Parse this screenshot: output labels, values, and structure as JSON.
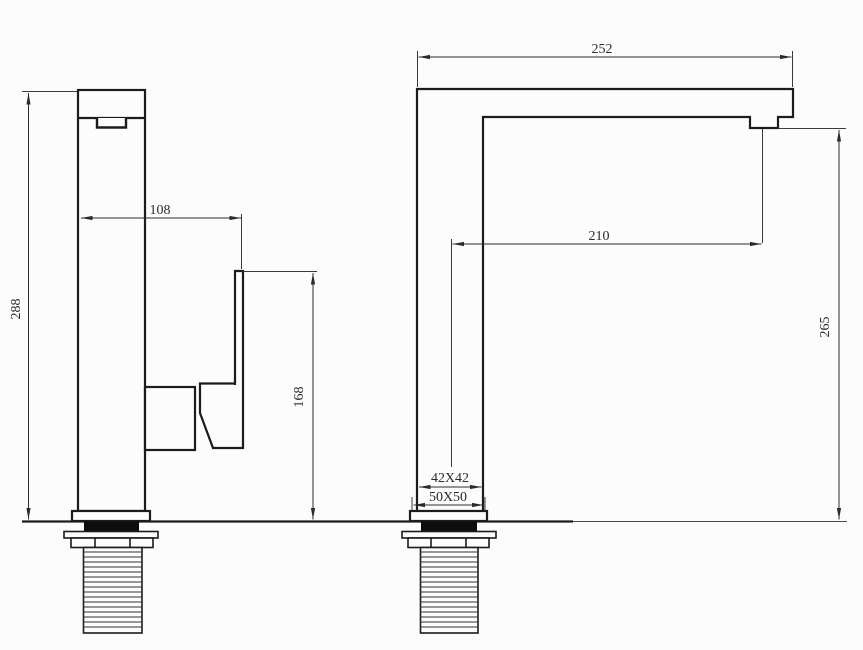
{
  "drawing": {
    "background_color": "#fcfcfc",
    "line_color": "#1c1c1c",
    "views": {
      "front": {
        "dims": {
          "total_height": "288",
          "body_to_handle_offset": "108",
          "handle_top_height": "168"
        }
      },
      "side": {
        "dims": {
          "spout_overall_length": "252",
          "spout_reach": "210",
          "outlet_height": "265",
          "body_section": "42X42",
          "base_section": "50X50"
        }
      }
    }
  }
}
